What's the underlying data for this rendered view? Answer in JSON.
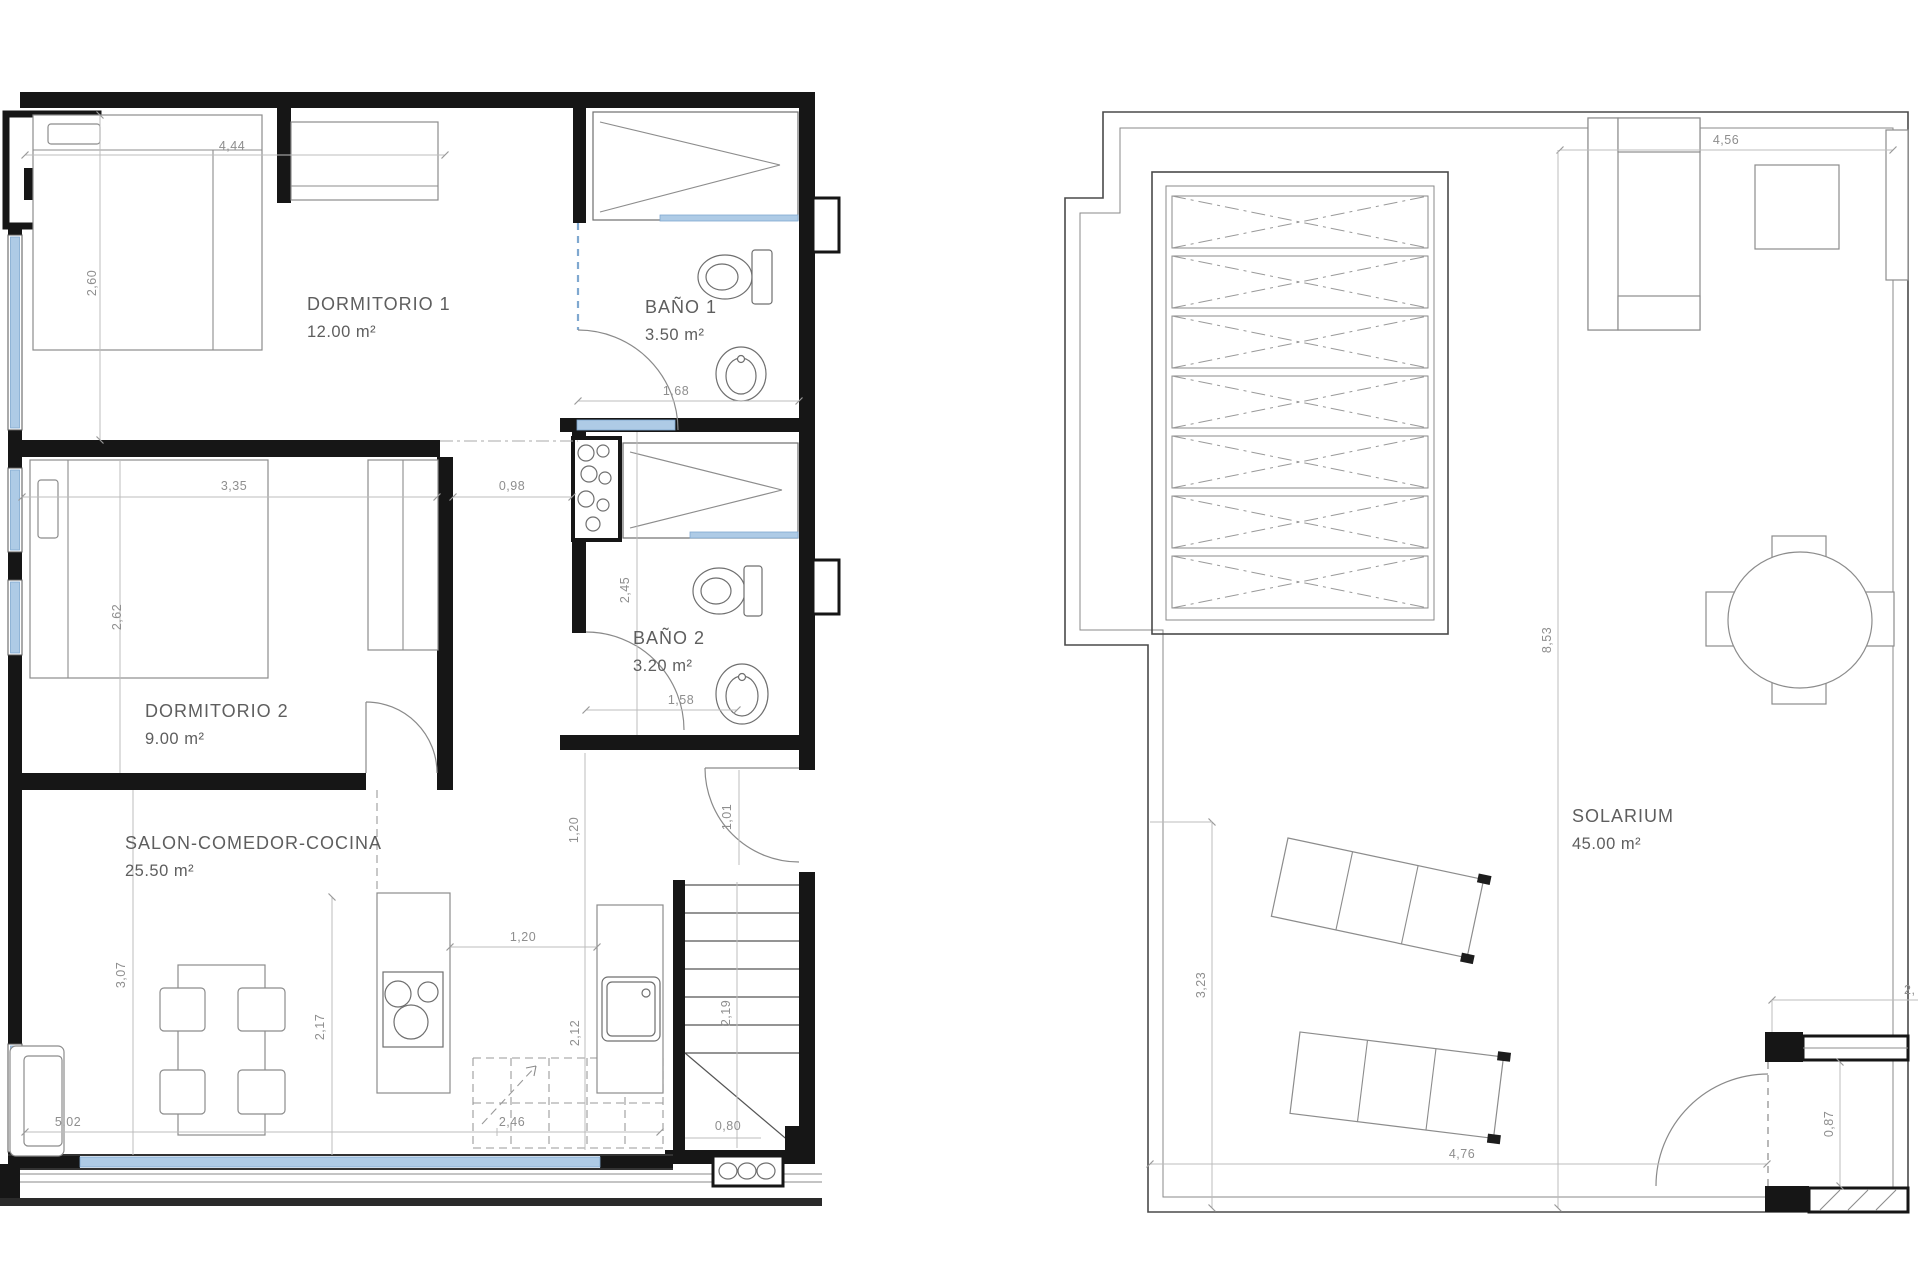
{
  "left_plan": {
    "rooms": {
      "dormitorio1": {
        "name": "DORMITORIO 1",
        "area": "12.00 m²"
      },
      "bano1": {
        "name": "BAÑO 1",
        "area": "3.50 m²"
      },
      "dormitorio2": {
        "name": "DORMITORIO 2",
        "area": "9.00 m²"
      },
      "bano2": {
        "name": "BAÑO 2",
        "area": "3.20 m²"
      },
      "salon": {
        "name": "SALON-COMEDOR-COCINA",
        "area": "25.50 m²"
      }
    },
    "dimensions": {
      "top_width": "4,44",
      "dorm1_height": "2,60",
      "dorm2_width": "3,35",
      "dorm2_height": "2,62",
      "hall_width": "0,98",
      "bano1_width": "1,68",
      "bano2_height": "2,45",
      "bano2_width": "1,58",
      "entry_depth": "1,20",
      "entry_door": "1,01",
      "salon_height": "3,07",
      "salon_mid": "2,17",
      "kitchen_gap": "1,20",
      "kitchen_run": "2,12",
      "stair_run": "2,19",
      "stair_width": "0,80",
      "salon_width": "5,02",
      "kitchen_width": "2,46"
    }
  },
  "right_plan": {
    "rooms": {
      "solarium": {
        "name": "SOLARIUM",
        "area": "45.00 m²"
      }
    },
    "dimensions": {
      "top_width": "4,56",
      "total_height": "8,53",
      "left_height": "3,23",
      "bottom_width": "4,76",
      "door_width": "0,87",
      "edge_partial": "2,"
    }
  }
}
